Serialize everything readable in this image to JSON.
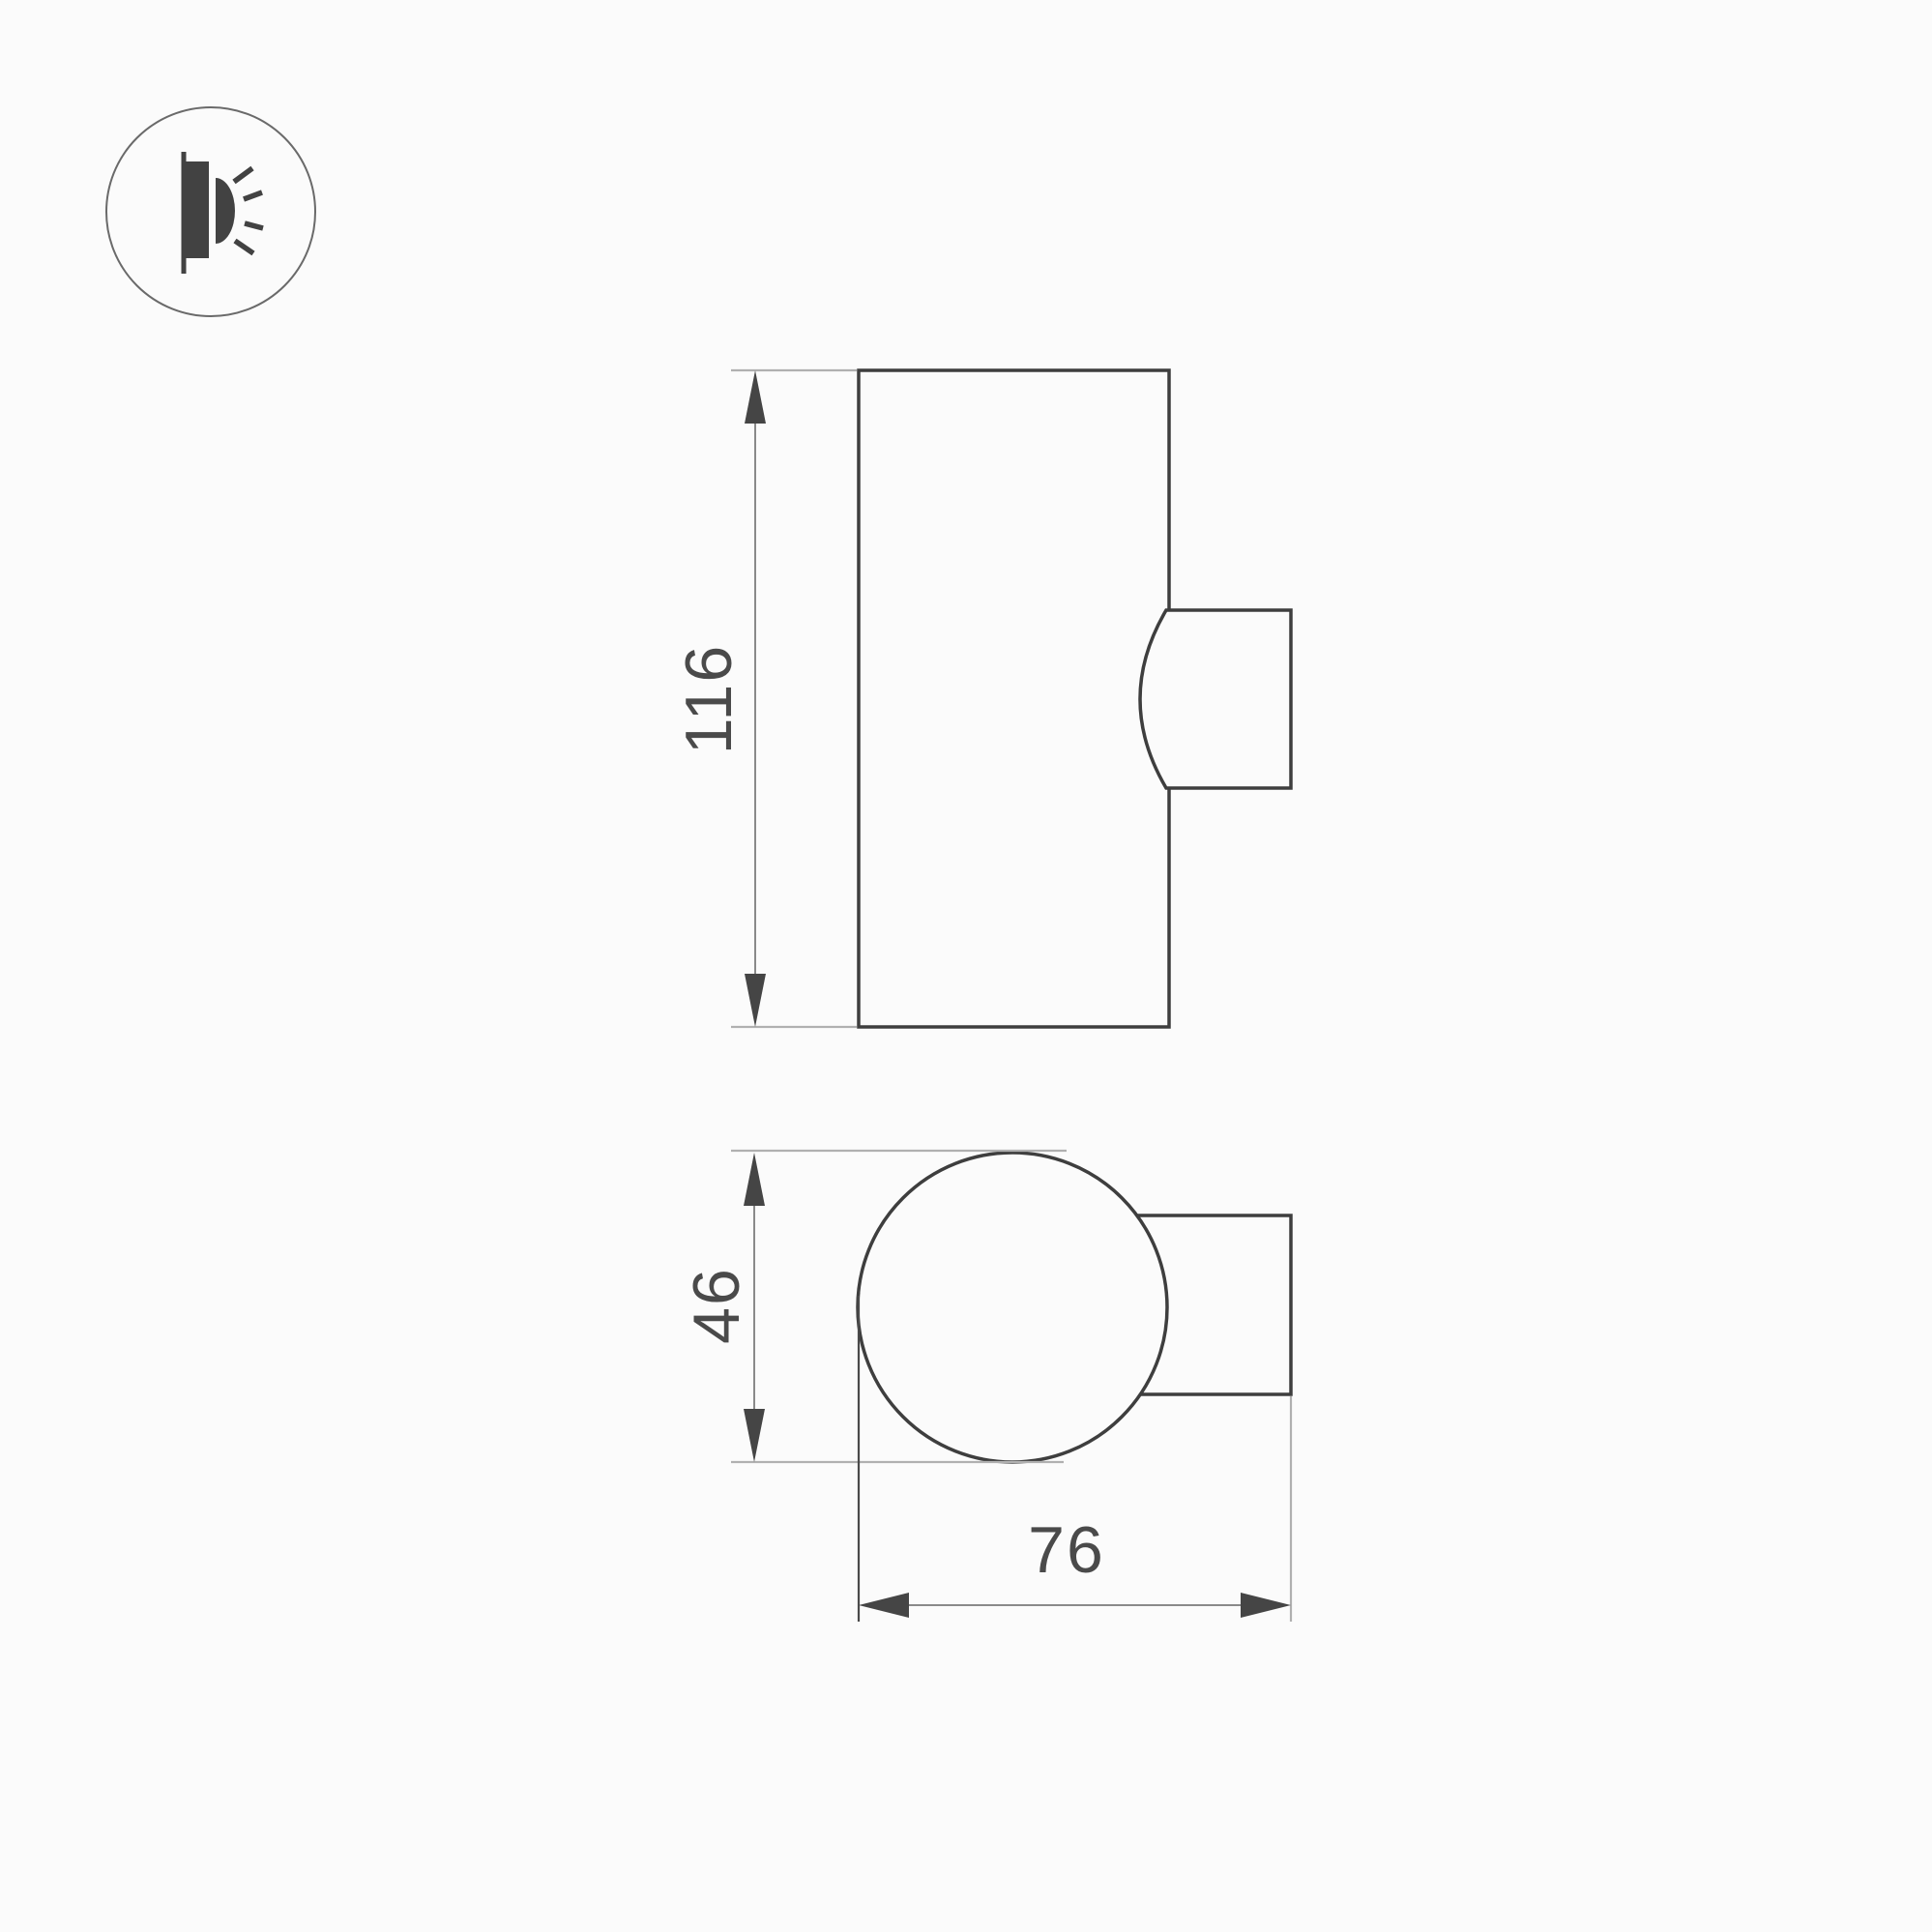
{
  "icon": {
    "name": "wall-light-icon"
  },
  "dimensions": {
    "height": "116",
    "diameter": "46",
    "depth": "76"
  },
  "colors": {
    "background": "#fbfbfb",
    "outline_dark": "#3e3e3e",
    "dimension_line": "#8a8a8a",
    "extension_line": "#b0b0b0",
    "extension_line_dark": "#4a4a4a",
    "arrow": "#454545",
    "text": "#4a4a4a",
    "icon_fill": "#424242",
    "icon_circle": "#6a6a6a"
  }
}
